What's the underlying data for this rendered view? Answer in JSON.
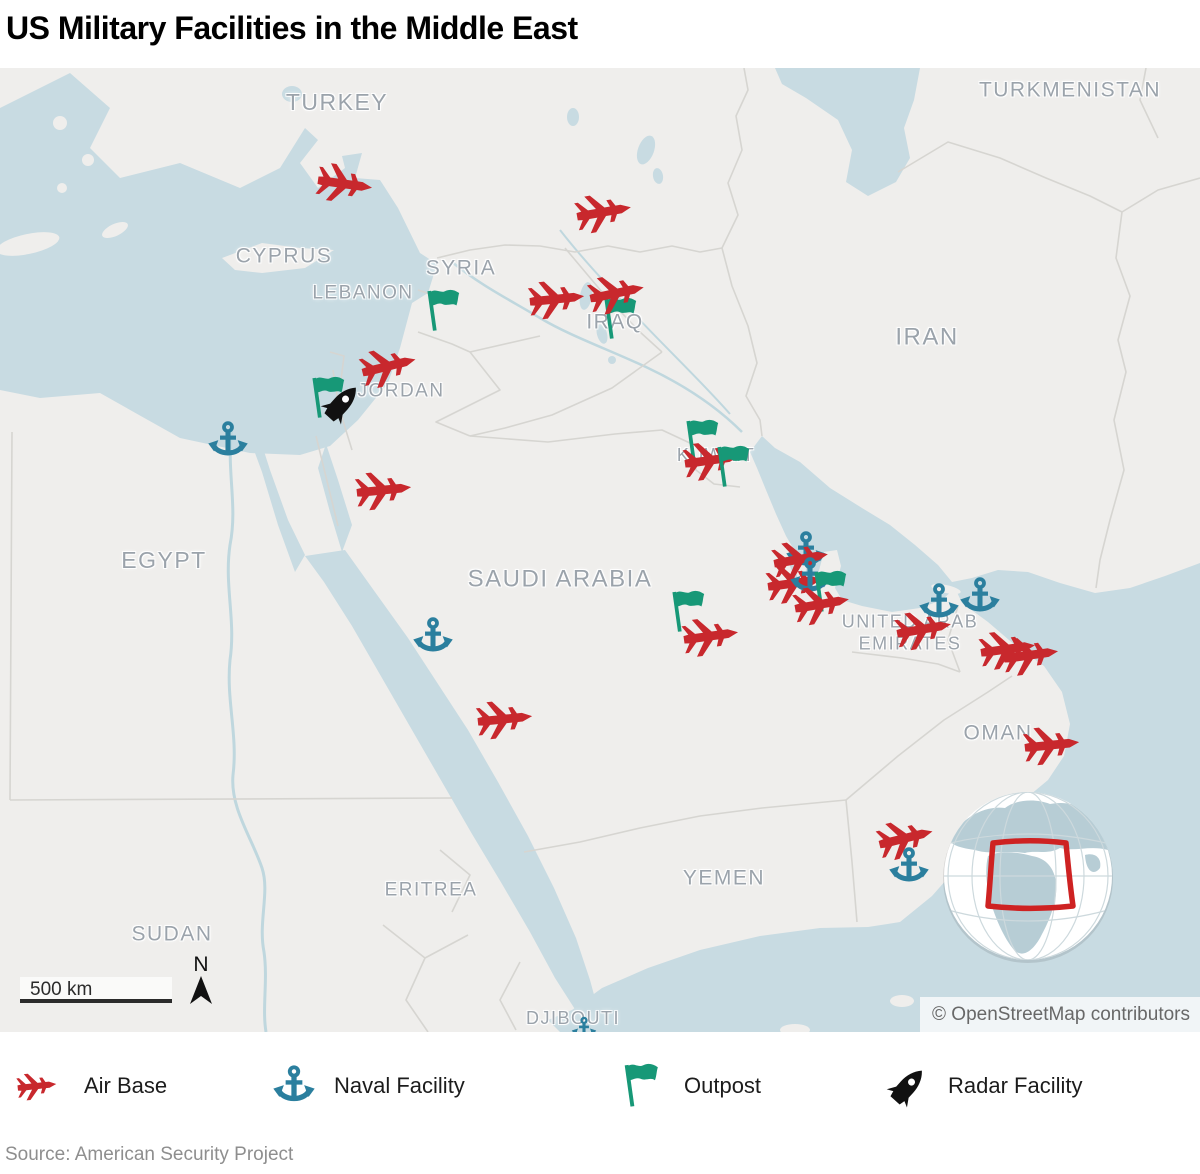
{
  "title": "US Military Facilities in the Middle East",
  "colors": {
    "air_base": "#C8282D",
    "naval": "#2B7F9E",
    "outpost": "#179877",
    "radar": "#111111",
    "land": "#EFEEEC",
    "water": "#C8DBE2"
  },
  "map": {
    "attribution": "© OpenStreetMap contributors",
    "scale_label": "500 km",
    "north_label": "N",
    "country_labels": [
      {
        "text": "TURKEY",
        "x": 337,
        "y": 103,
        "size": 23
      },
      {
        "text": "TURKMENISTAN",
        "x": 1070,
        "y": 90,
        "size": 21
      },
      {
        "text": "CYPRUS",
        "x": 284,
        "y": 256,
        "size": 21
      },
      {
        "text": "SYRIA",
        "x": 461,
        "y": 268,
        "size": 21
      },
      {
        "text": "LEBANON",
        "x": 363,
        "y": 294,
        "size": 19
      },
      {
        "text": "IRAQ",
        "x": 615,
        "y": 322,
        "size": 21
      },
      {
        "text": "IRAN",
        "x": 927,
        "y": 338,
        "size": 24
      },
      {
        "text": "JORDAN",
        "x": 401,
        "y": 392,
        "size": 19
      },
      {
        "text": "KUWAIT",
        "x": 716,
        "y": 456,
        "size": 18
      },
      {
        "text": "EGYPT",
        "x": 164,
        "y": 561,
        "size": 23
      },
      {
        "text": "SAUDI ARABIA",
        "x": 560,
        "y": 580,
        "size": 24
      },
      {
        "text": "UNITED ARAB\nEMIRATES",
        "x": 910,
        "y": 633,
        "size": 18
      },
      {
        "text": "OMAN",
        "x": 998,
        "y": 733,
        "size": 21
      },
      {
        "text": "YEMEN",
        "x": 724,
        "y": 878,
        "size": 21
      },
      {
        "text": "ERITREA",
        "x": 431,
        "y": 891,
        "size": 19
      },
      {
        "text": "SUDAN",
        "x": 172,
        "y": 934,
        "size": 21
      },
      {
        "text": "DJIBOUTI",
        "x": 573,
        "y": 1019,
        "size": 18
      }
    ],
    "markers": [
      {
        "type": "air-base",
        "x": 345,
        "y": 184,
        "rot": 8
      },
      {
        "type": "air-base",
        "x": 604,
        "y": 212,
        "rot": -10
      },
      {
        "type": "air-base",
        "x": 557,
        "y": 299,
        "rot": -6
      },
      {
        "type": "outpost",
        "x": 621,
        "y": 319
      },
      {
        "type": "air-base",
        "x": 617,
        "y": 293,
        "rot": -12
      },
      {
        "type": "outpost",
        "x": 444,
        "y": 311
      },
      {
        "type": "outpost",
        "x": 329,
        "y": 398
      },
      {
        "type": "radar",
        "x": 342,
        "y": 403,
        "rot": 42
      },
      {
        "type": "air-base",
        "x": 389,
        "y": 366,
        "rot": -14
      },
      {
        "type": "air-base",
        "x": 384,
        "y": 490,
        "rot": -6
      },
      {
        "type": "naval",
        "x": 228,
        "y": 441
      },
      {
        "type": "outpost",
        "x": 703,
        "y": 441
      },
      {
        "type": "air-base",
        "x": 712,
        "y": 460,
        "rot": -8
      },
      {
        "type": "outpost",
        "x": 734,
        "y": 467
      },
      {
        "type": "naval",
        "x": 433,
        "y": 637
      },
      {
        "type": "naval",
        "x": 806,
        "y": 551
      },
      {
        "type": "air-base",
        "x": 801,
        "y": 559,
        "rot": -10
      },
      {
        "type": "air-base",
        "x": 795,
        "y": 583,
        "rot": -8
      },
      {
        "type": "naval",
        "x": 810,
        "y": 577
      },
      {
        "type": "outpost",
        "x": 831,
        "y": 592
      },
      {
        "type": "air-base",
        "x": 822,
        "y": 604,
        "rot": -10
      },
      {
        "type": "outpost",
        "x": 689,
        "y": 612
      },
      {
        "type": "air-base",
        "x": 711,
        "y": 636,
        "rot": -8
      },
      {
        "type": "air-base",
        "x": 505,
        "y": 719,
        "rot": -6
      },
      {
        "type": "naval",
        "x": 939,
        "y": 603
      },
      {
        "type": "naval",
        "x": 980,
        "y": 597
      },
      {
        "type": "air-base",
        "x": 924,
        "y": 629,
        "rot": -10
      },
      {
        "type": "air-base",
        "x": 1008,
        "y": 649,
        "rot": -8
      },
      {
        "type": "air-base",
        "x": 1031,
        "y": 655,
        "rot": -8
      },
      {
        "type": "air-base",
        "x": 1052,
        "y": 745,
        "rot": -6
      },
      {
        "type": "air-base",
        "x": 906,
        "y": 838,
        "rot": -14
      },
      {
        "type": "naval",
        "x": 909,
        "y": 867
      },
      {
        "type": "naval",
        "x": 584,
        "y": 1029,
        "size": 26
      }
    ]
  },
  "legend": {
    "items": [
      {
        "type": "air-base",
        "label": "Air Base"
      },
      {
        "type": "naval",
        "label": "Naval Facility"
      },
      {
        "type": "outpost",
        "label": "Outpost"
      },
      {
        "type": "radar",
        "label": "Radar Facility"
      }
    ]
  },
  "source": "Source: American Security Project"
}
